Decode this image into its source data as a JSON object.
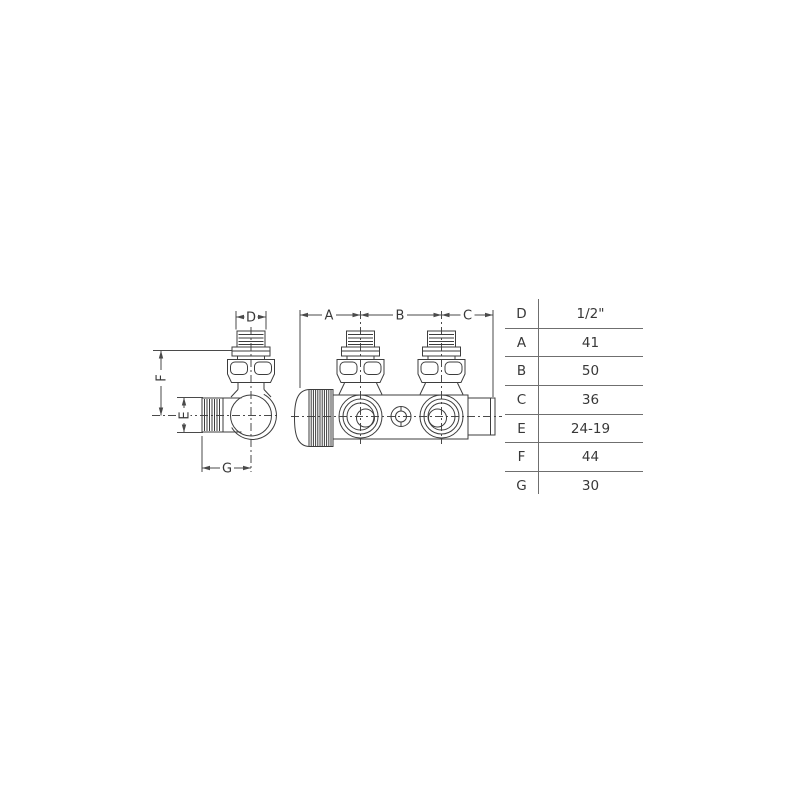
{
  "drawing": {
    "description": "Technical drawing of a twin radiator valve, two views with dimension callouts",
    "dimensions": {
      "a": "A",
      "b": "B",
      "c": "C",
      "d": "D",
      "e": "E",
      "f": "F",
      "g": "G"
    }
  },
  "table": {
    "rows": [
      {
        "label": "D",
        "value": "1/2\""
      },
      {
        "label": "A",
        "value": "41"
      },
      {
        "label": "B",
        "value": "50"
      },
      {
        "label": "C",
        "value": "36"
      },
      {
        "label": "E",
        "value": "24-19"
      },
      {
        "label": "F",
        "value": "44"
      },
      {
        "label": "G",
        "value": "30"
      }
    ]
  },
  "colors": {
    "background": "#ffffff",
    "drawing_line": "#3d3d3d",
    "dimension_line": "#4a4a4a",
    "table_line": "#6f6f6f",
    "text": "#383838"
  }
}
